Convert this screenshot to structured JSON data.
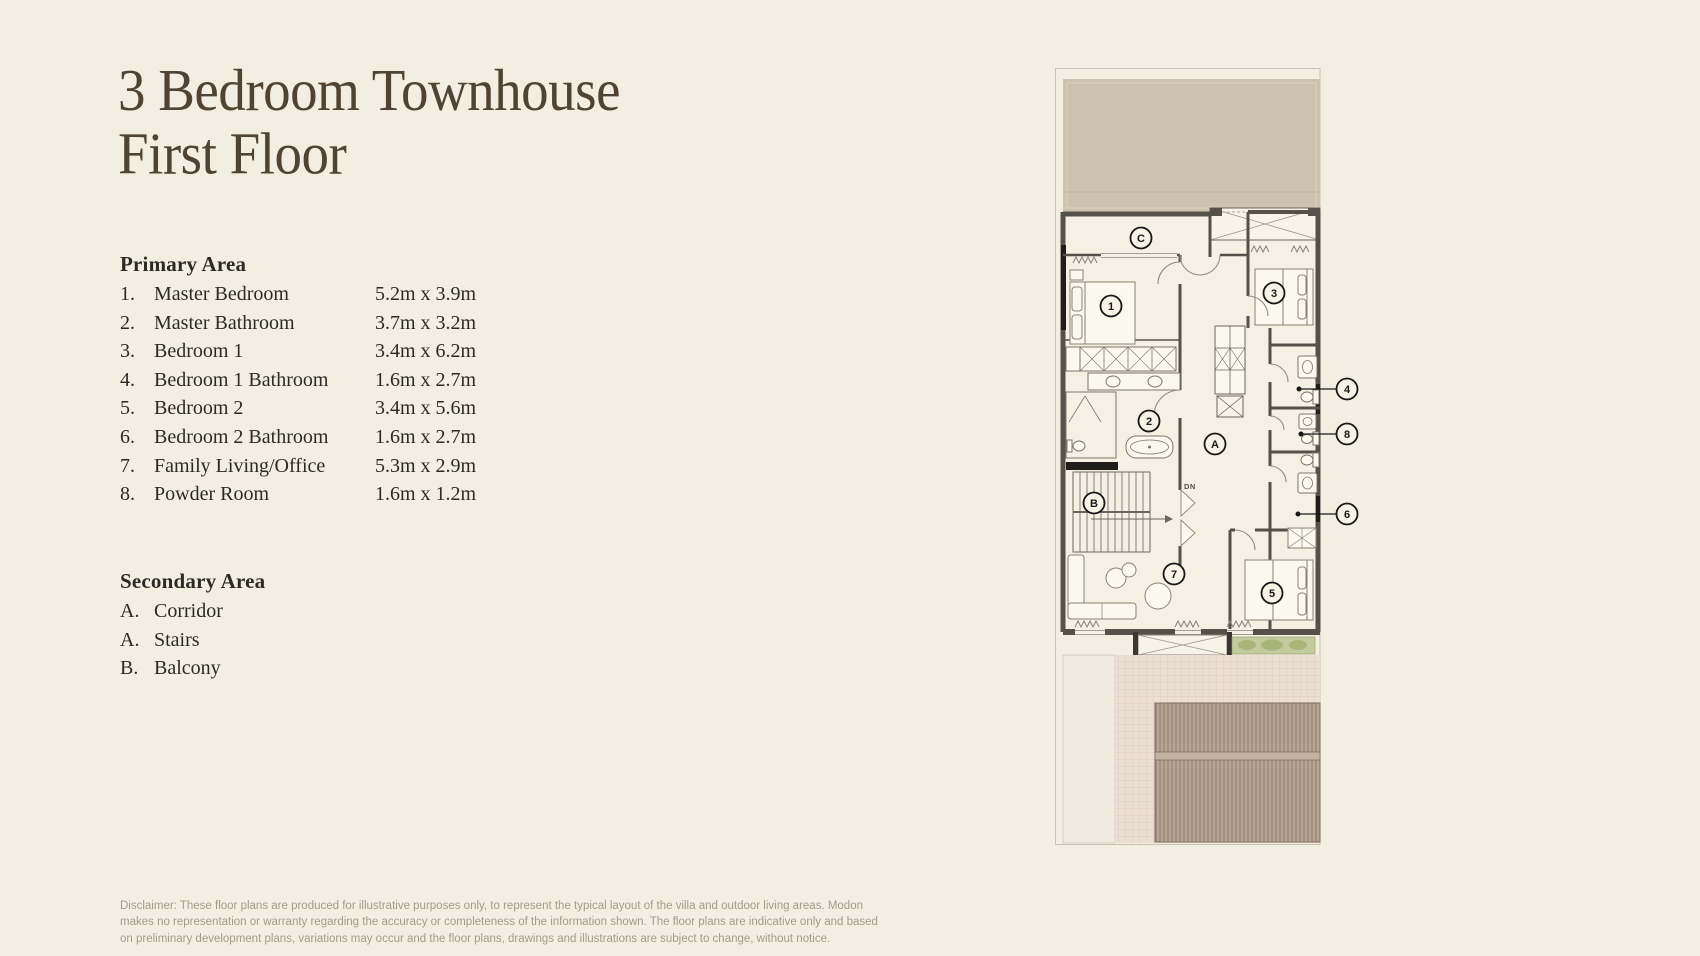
{
  "page": {
    "background": "#f2efe2",
    "title": {
      "line1": "3 Bedroom Townhouse",
      "line2": "First Floor",
      "color": "#4f4431"
    },
    "disclaimer": {
      "line1": "Disclaimer: These floor plans are produced for illustrative purposes only, to represent the typical layout of the villa and outdoor living areas. Modon",
      "line2": "makes no representation or warranty regarding the accuracy or completeness of the information shown. The floor plans are indicative only and based",
      "line3": "on preliminary development plans, variations may occur and the floor plans, drawings and illustrations are subject to change, without notice."
    }
  },
  "legend": {
    "primary": {
      "heading": "Primary Area",
      "items": [
        {
          "num": "1.",
          "label": "Master Bedroom",
          "dims": "5.2m x 3.9m"
        },
        {
          "num": "2.",
          "label": "Master Bathroom",
          "dims": "3.7m x 3.2m"
        },
        {
          "num": "3.",
          "label": "Bedroom 1",
          "dims": "3.4m x 6.2m"
        },
        {
          "num": "4.",
          "label": "Bedroom 1 Bathroom",
          "dims": "1.6m x 2.7m"
        },
        {
          "num": "5.",
          "label": "Bedroom 2",
          "dims": "3.4m x 5.6m"
        },
        {
          "num": "6.",
          "label": "Bedroom 2 Bathroom",
          "dims": "1.6m x 2.7m"
        },
        {
          "num": "7.",
          "label": "Family Living/Office",
          "dims": "5.3m x 2.9m"
        },
        {
          "num": "8.",
          "label": "Powder Room",
          "dims": "1.6m x 1.2m"
        }
      ]
    },
    "secondary": {
      "heading": "Secondary Area",
      "items": [
        {
          "num": "A.",
          "label": "Corridor"
        },
        {
          "num": "A.",
          "label": "Stairs"
        },
        {
          "num": "B.",
          "label": "Balcony"
        }
      ]
    }
  },
  "plan": {
    "callouts": {
      "c1": "1",
      "c2": "2",
      "c3": "3",
      "c4": "4",
      "c5": "5",
      "c6": "6",
      "c7": "7",
      "c8": "8",
      "ca": "A",
      "cb": "B",
      "cc": "C"
    },
    "stairs_direction": "DN",
    "colors": {
      "terrace": "#cdc1af",
      "wall": "#55504a",
      "paving": "#ebded3",
      "deck": "#b7a695",
      "planter": "#c2ca9e"
    }
  }
}
